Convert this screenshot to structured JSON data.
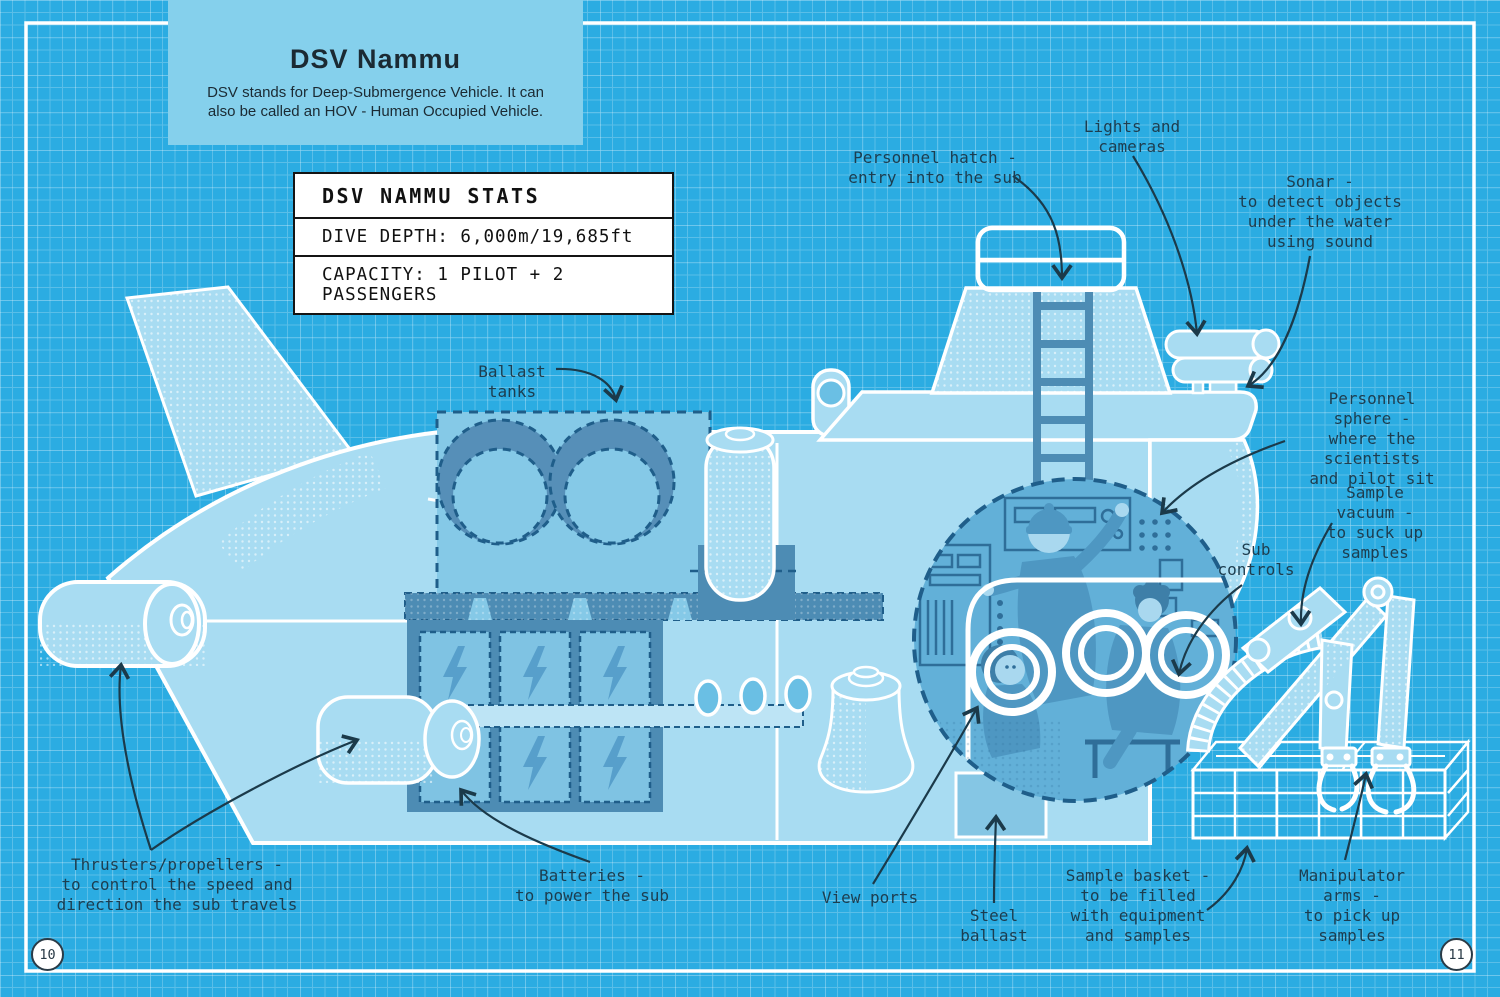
{
  "title_card": {
    "title": "DSV Nammu",
    "subtitle": "DSV stands for Deep-Submergence Vehicle. It can\nalso be called an HOV - Human Occupied Vehicle."
  },
  "stats_card": {
    "header": "DSV NAMMU STATS",
    "rows": [
      "DIVE DEPTH: 6,000m/19,685ft",
      "CAPACITY: 1 PILOT + 2 PASSENGERS"
    ]
  },
  "labels": {
    "personnel_hatch": "Personnel hatch -\nentry into the sub",
    "lights_cameras": "Lights and\ncameras",
    "sonar": "Sonar -\nto detect objects\nunder the water\nusing sound",
    "personnel_sphere": "Personnel sphere -\nwhere the scientists\nand pilot sit",
    "sample_vacuum": "Sample vacuum -\nto suck up samples",
    "sub_controls": "Sub\ncontrols",
    "ballast_tanks": "Ballast\ntanks",
    "thrusters": "Thrusters/propellers -\nto control the speed and\ndirection the sub travels",
    "batteries": "Batteries -\nto power the sub",
    "view_ports": "View ports",
    "steel_ballast": "Steel\nballast",
    "sample_basket": "Sample basket -\nto be filled\nwith equipment\nand samples",
    "manipulator_arms": "Manipulator arms -\nto pick up samples"
  },
  "page": {
    "left_number": "10",
    "right_number": "11"
  },
  "colors": {
    "background": "#2BACE2",
    "hull_light": "#A8DCF2",
    "mid_blue": "#568FB8",
    "dashed_blue": "#1f5e8a",
    "ink": "#1d3d4f",
    "line_white": "#ffffff"
  }
}
